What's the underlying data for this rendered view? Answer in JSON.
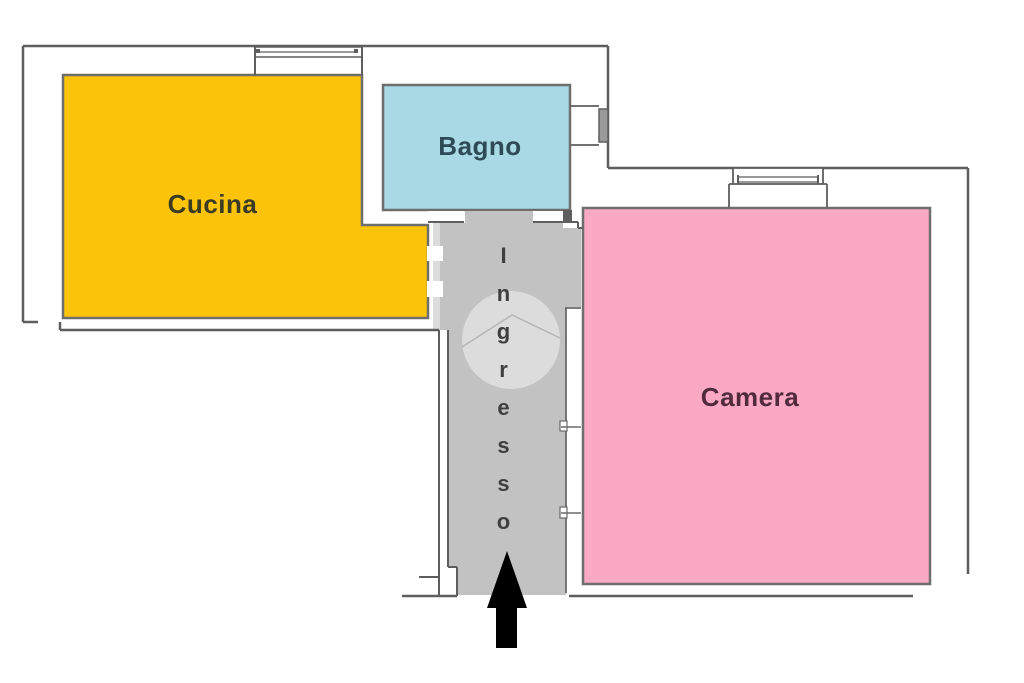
{
  "app": {
    "type": "apartment-floor-plan",
    "language": "Italian",
    "background": "#FFFFFF",
    "canvas": {
      "width": 1024,
      "height": 683
    }
  },
  "rooms": {
    "cucina": {
      "label": "Cucina",
      "fill": "#FCC30B",
      "label_color": "#3B3B23",
      "position": "top-left"
    },
    "bagno": {
      "label": "Bagno",
      "fill": "#A9D9E5",
      "label_color": "#2E4A57",
      "position": "top-center"
    },
    "camera": {
      "label": "Camera",
      "fill": "#F9A9C3",
      "label_color": "#512B3D",
      "position": "right"
    },
    "ingresso": {
      "label": "Ingresso",
      "fill": "#C3C2C2",
      "label_color": "#3F3F3F",
      "position": "center-corridor",
      "label_orientation": "vertical"
    }
  },
  "symbols": {
    "wall_color": "#5E5E5E",
    "entrance_arrow": {
      "meaning": "main entrance",
      "direction": "up",
      "color": "#000000"
    },
    "door_swing_circle": {
      "fill": "#DCDCDC",
      "line_color": "#B5B5B5"
    },
    "door_dash_color": "#FFFFFF",
    "window_bar_fill": "#9A9A9A",
    "windows": [
      {
        "location": "top-wall-above-cucina"
      },
      {
        "location": "right-of-bagno"
      },
      {
        "location": "top-of-camera"
      }
    ]
  }
}
